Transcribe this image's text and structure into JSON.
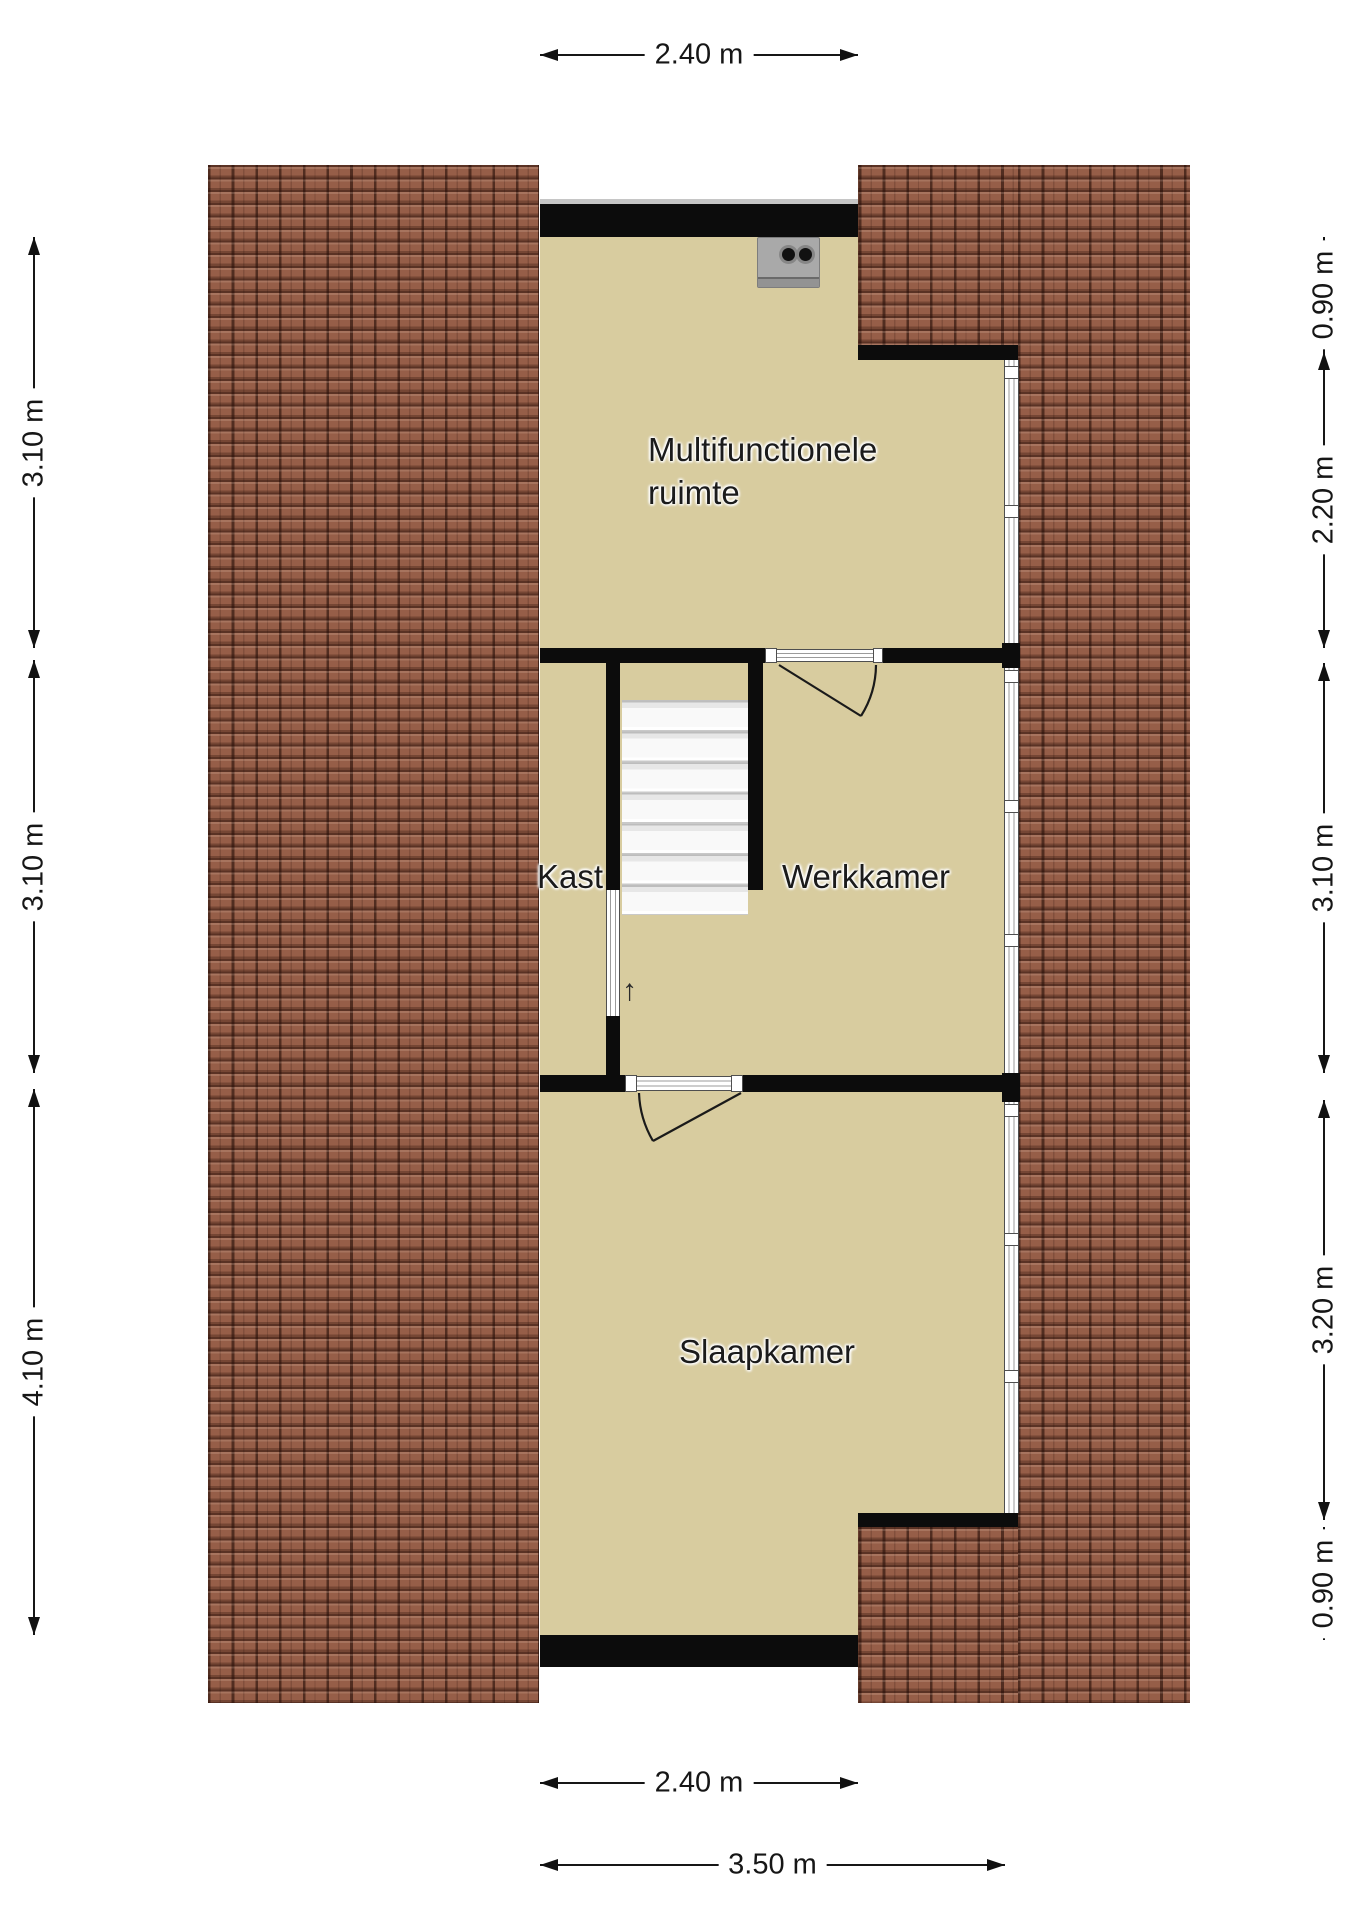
{
  "rooms": {
    "multifunctionele_line1": "Multifunctionele",
    "multifunctionele_line2": "ruimte",
    "kast": "Kast",
    "werkkamer": "Werkkamer",
    "slaapkamer": "Slaapkamer"
  },
  "dimensions": {
    "top_width": "2.40 m",
    "left_top": "3.10 m",
    "left_middle": "3.10 m",
    "left_bottom": "4.10 m",
    "right_1": "0.90 m",
    "right_2": "2.20 m",
    "right_3": "3.10 m",
    "right_4": "3.20 m",
    "right_5": "0.90 m",
    "bottom_inner": "2.40 m",
    "bottom_outer": "3.50 m"
  },
  "stairs": {
    "direction_icon": "↑"
  },
  "colors": {
    "floor": "#d8cc9f",
    "roof_tile": "#965e48",
    "wall": "#0c0c0c",
    "dimension": "#161616"
  }
}
